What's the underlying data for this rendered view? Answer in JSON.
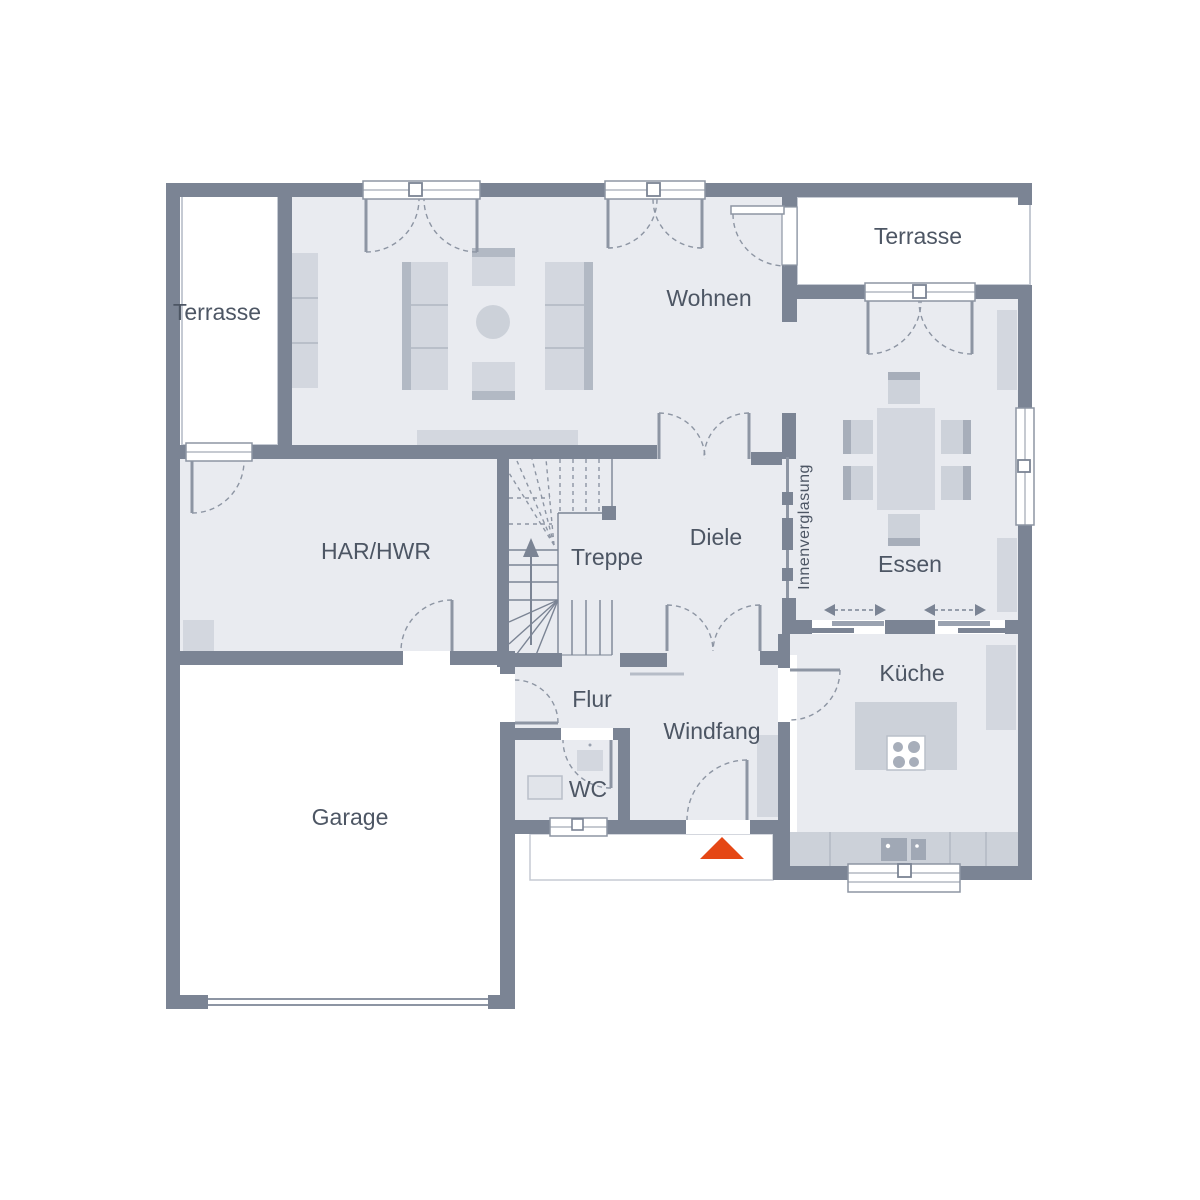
{
  "rooms": {
    "terrasse_left": {
      "label": "Terrasse"
    },
    "wohnen": {
      "label": "Wohnen"
    },
    "terrasse_right": {
      "label": "Terrasse"
    },
    "har_hwr": {
      "label": "HAR/HWR"
    },
    "treppe": {
      "label": "Treppe"
    },
    "diele": {
      "label": "Diele"
    },
    "innenverglasung": {
      "label": "Innenverglasung"
    },
    "essen": {
      "label": "Essen"
    },
    "flur": {
      "label": "Flur"
    },
    "windfang": {
      "label": "Windfang"
    },
    "wc": {
      "label": "WC"
    },
    "kueche": {
      "label": "Küche"
    },
    "garage": {
      "label": "Garage"
    }
  },
  "colors": {
    "wall": "#7b8494",
    "room_fill": "#e9ebf0",
    "furniture": "#d3d7df",
    "furniture_dark": "#b2b9c4",
    "counter": "#ccd1d9",
    "fixture_dark": "#a0a8b5",
    "symbol_line": "#8d95a3",
    "entrance_arrow": "#e54715",
    "label_text": "#4d5664",
    "outdoor": "#ffffff"
  }
}
